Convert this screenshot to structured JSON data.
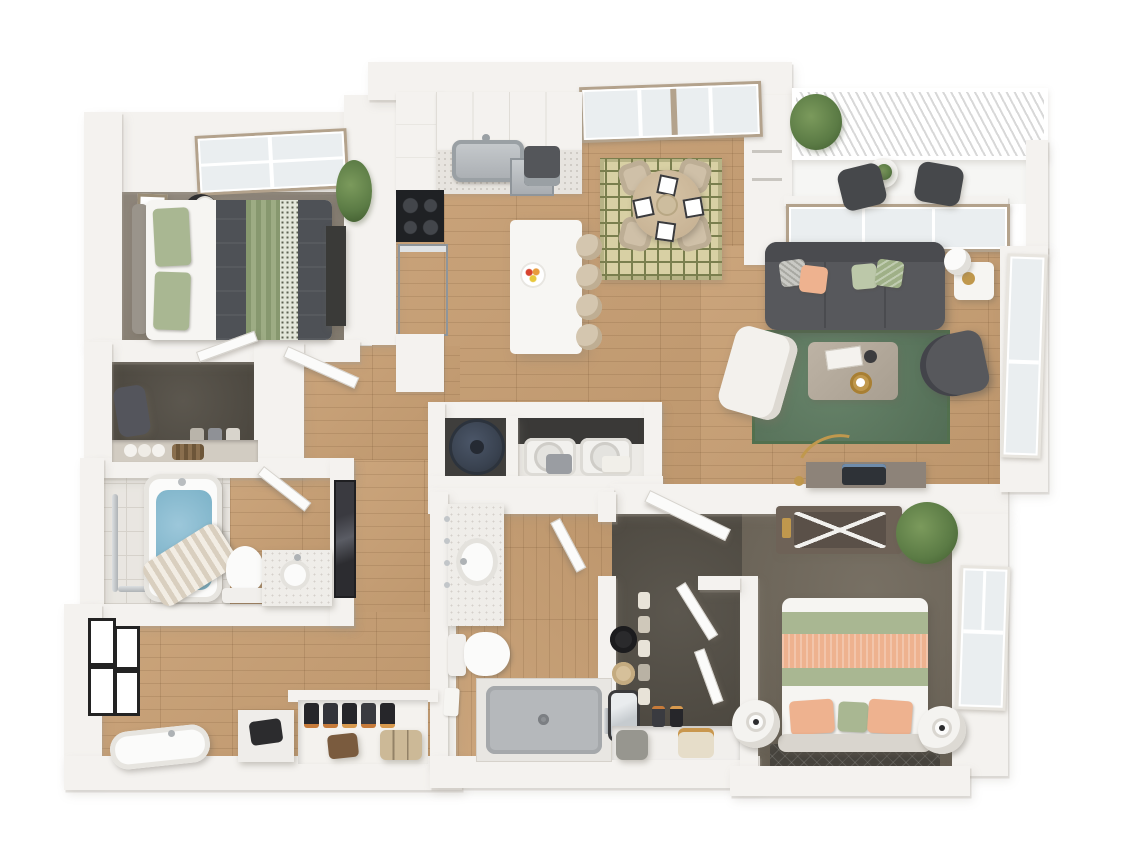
{
  "scene": {
    "kind": "3d-floor-plan-render",
    "view": "top-down dollhouse",
    "units_shown": "none",
    "text_labels": "none"
  },
  "palette": {
    "page": "#ffffff",
    "wall": "#f4f2ef",
    "wallEdge": "#d8d5cf",
    "wood": "#c79e72",
    "carpetBed1": "#8d8478",
    "carpetBed2": "#6f675a",
    "carpetCloset": "#534e45",
    "tile": "#e9e6e1",
    "tileLine": "#d6d2cb",
    "deck": "#f6f6f4",
    "railing": "#d8d8d8",
    "winFrame": "#b3a28c",
    "winGlass": "#eaeef0",
    "rugGreen": "#5e7c61",
    "rugGreenEdge": "#52704e",
    "rugDining": "#d8d0a4",
    "rugDiningPat": "#7a7f4e",
    "rugDark": "#47443e",
    "sofa": "#57585c",
    "sofaDark": "#4a4b4f",
    "duvet": "#4e5156",
    "sage": "#a9b792",
    "sageLight": "#bcc8a9",
    "peach": "#eeb28f",
    "mattress": "#f6f5f2",
    "headboard": "#9a948b",
    "headboard2": "#d9d5ce",
    "stainless": "#b6babd",
    "applianceDark": "#2a2c30",
    "cooktop": "#1f2124",
    "waterHeater": "#3a4351",
    "tubWater": "#7ab1c7",
    "showerPan": "#b5b8bb",
    "marble": "#efede9",
    "consoleWood": "#8d8379",
    "dresserWood": "#6e6257",
    "chairTan": "#cfc0a8",
    "stoolTan": "#d4c6af",
    "tableWood": "#c8b395",
    "gold": "#c0984d",
    "plant": "#5b7b45",
    "plantLight": "#7b9a5c",
    "plantDark": "#3f5a2e",
    "frameBlack": "#232323",
    "mirrorDark": "#2c2c30",
    "curtain": "#d9cfbf",
    "suitcase": "#ccb997",
    "leather": "#7a5b3e"
  },
  "floorplan": {
    "rooms": [
      {
        "id": "bedroom-1",
        "floor": "gray-carpet",
        "items": [
          "window",
          "wall-art",
          "round-side-table",
          "table-lamp",
          "queen-bed",
          "sage-pillows",
          "charcoal-duvet",
          "striped-throw",
          "tall-dresser",
          "potted-plant"
        ]
      },
      {
        "id": "walk-in-closet-1",
        "floor": "dark-carpet",
        "items": [
          "backpack",
          "shoe-pairs",
          "rolled-towels",
          "woven-basket",
          "shelf"
        ]
      },
      {
        "id": "bathroom-1",
        "floor": "marble-tile-and-wood",
        "items": [
          "grab-bars",
          "bathtub-with-water",
          "striped-shower-curtain",
          "toilet",
          "vanity-with-round-sink",
          "full-length-mirror"
        ]
      },
      {
        "id": "entry-hall",
        "floor": "wood",
        "items": [
          "gallery-wall-four-frames",
          "freestanding-tub",
          "console-table",
          "vintage-black-machine",
          "coat-closet",
          "shoe-row",
          "leather-bag",
          "suitcase"
        ]
      },
      {
        "id": "kitchen",
        "floor": "wood",
        "items": [
          "upper-cabinets",
          "farmhouse-sink",
          "faucet",
          "coffee-maker",
          "dishwasher",
          "cooktop",
          "wall-oven",
          "base-cabinets",
          "island",
          "fruit-plate",
          "bar-stools-x4",
          "tall-cabinet-refrigerator",
          "double-window"
        ]
      },
      {
        "id": "dining-area",
        "floor": "wood",
        "items": [
          "geometric-rug",
          "round-dining-table",
          "tub-chairs-x4",
          "place-settings-x4",
          "centerpiece"
        ]
      },
      {
        "id": "living-room",
        "floor": "wood",
        "items": [
          "sofa",
          "throw-pillows-x4",
          "green-area-rug",
          "coffee-table",
          "magazines",
          "vase",
          "gold-tray",
          "white-accent-chair",
          "dark-barrel-chair",
          "side-table",
          "sphere-lamp",
          "gold-bowl",
          "arc-floor-lamp",
          "media-console",
          "laptop",
          "tall-window",
          "window-band"
        ]
      },
      {
        "id": "balcony",
        "floor": "deck",
        "items": [
          "slatted-railing",
          "bistro-table",
          "bistro-chairs-x2",
          "potted-plant",
          "hanging-plant"
        ]
      },
      {
        "id": "utility-closet",
        "items": [
          "water-heater"
        ]
      },
      {
        "id": "laundry-closet",
        "items": [
          "washer",
          "dryer",
          "laundry-basket",
          "folded-towels"
        ]
      },
      {
        "id": "bathroom-2",
        "floor": "wood",
        "items": [
          "marble-vanity",
          "oval-sink",
          "wall-hooks",
          "toilet",
          "walk-in-shower",
          "shower-handle",
          "drain",
          "towel"
        ]
      },
      {
        "id": "walk-in-closet-2",
        "floor": "dark-carpet",
        "items": [
          "black-hat",
          "tan-hat",
          "mirror",
          "shoe-wall",
          "bottom-shelf",
          "hamper",
          "tote-bag",
          "shoe-row"
        ]
      },
      {
        "id": "bedroom-2",
        "floor": "taupe-carpet",
        "items": [
          "dresser",
          "luggage-rack",
          "gold-decor",
          "palm-plant",
          "queen-bed",
          "sage-bands",
          "peach-runner",
          "pillows-x3",
          "round-nightstands-x2",
          "lamps-x2",
          "accent-rug",
          "window",
          "entry-door"
        ]
      }
    ],
    "doors": [
      "bedroom-1-door",
      "closet-1-door",
      "bathroom-1-door",
      "bathroom-2-door",
      "bedroom-2-door",
      "closet-2-door-a",
      "closet-2-door-b"
    ],
    "windows": [
      "bedroom-1-north",
      "kitchen-north-double",
      "living-room-band",
      "living-room-east-tall",
      "bedroom-2-east"
    ]
  }
}
